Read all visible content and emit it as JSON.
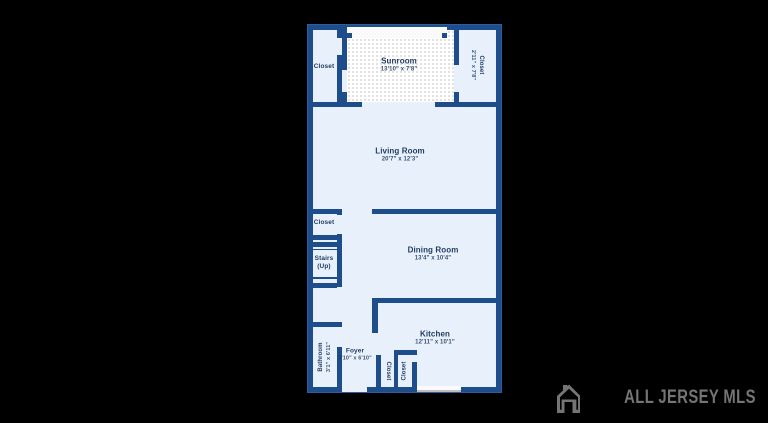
{
  "colors": {
    "wall": "#1d4e8b",
    "floor": "#e8f1fb",
    "sunroom_floor": "#ffffff",
    "label": "#1e3a5f",
    "background": "#000000",
    "watermark": "#757575"
  },
  "rooms": [
    {
      "id": "closet-top-left",
      "name": "Closet",
      "dims": ""
    },
    {
      "id": "sunroom",
      "name": "Sunroom",
      "dims": "13'10\" x 7'8\""
    },
    {
      "id": "closet-top-right",
      "name": "Closet",
      "dims": "2'11\" x 7'8\""
    },
    {
      "id": "living-room",
      "name": "Living Room",
      "dims": "20'7\" x 12'3\""
    },
    {
      "id": "closet-middle-left",
      "name": "Closet",
      "dims": ""
    },
    {
      "id": "stairs",
      "name": "Stairs",
      "dims": "(Up)"
    },
    {
      "id": "dining-room",
      "name": "Dining Room",
      "dims": "13'4\" x 10'4\""
    },
    {
      "id": "kitchen",
      "name": "Kitchen",
      "dims": "12'11\" x 10'1\""
    },
    {
      "id": "bathroom",
      "name": "Bathroom",
      "dims": "3'1\" x 6'11\""
    },
    {
      "id": "foyer",
      "name": "Foyer",
      "dims": "3'10\" x 6'10\""
    },
    {
      "id": "closet-bottom-left",
      "name": "Closet",
      "dims": ""
    },
    {
      "id": "closet-bottom-right",
      "name": "Closet",
      "dims": ""
    }
  ],
  "watermark": {
    "text": "ALL JERSEY MLS",
    "icon": "house-logo-icon"
  }
}
